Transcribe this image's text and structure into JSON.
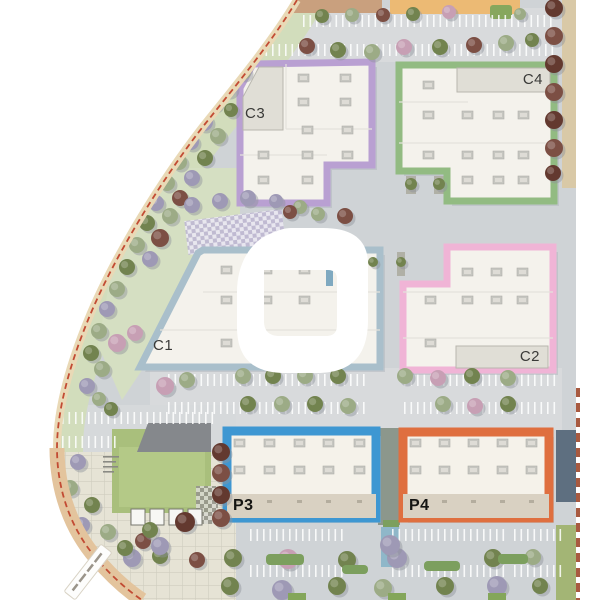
{
  "canvas": {
    "width": 600,
    "height": 600,
    "background_color": "#ffffff"
  },
  "site_plan": {
    "buildings": [
      {
        "id": "c1",
        "label": "C1",
        "outline_color": "#a9bfcb"
      },
      {
        "id": "c2",
        "label": "C2",
        "outline_color": "#f0b4d6"
      },
      {
        "id": "c3",
        "label": "C3",
        "outline_color": "#b9a0d2"
      },
      {
        "id": "c4",
        "label": "C4",
        "outline_color": "#92bb82"
      },
      {
        "id": "p3",
        "label": "P3",
        "outline_color": "#3e97d2"
      },
      {
        "id": "p4",
        "label": "P4",
        "outline_color": "#df6f3f"
      }
    ],
    "partial_top_buildings": [
      {
        "color": "#c9a07e"
      },
      {
        "color": "#ecba74"
      }
    ],
    "boundary": {
      "dash_color": "#c24b33",
      "road_color": "#e9d9b6"
    },
    "watermark": {
      "name": "white-ring-logo",
      "color": "#ffffff"
    }
  }
}
